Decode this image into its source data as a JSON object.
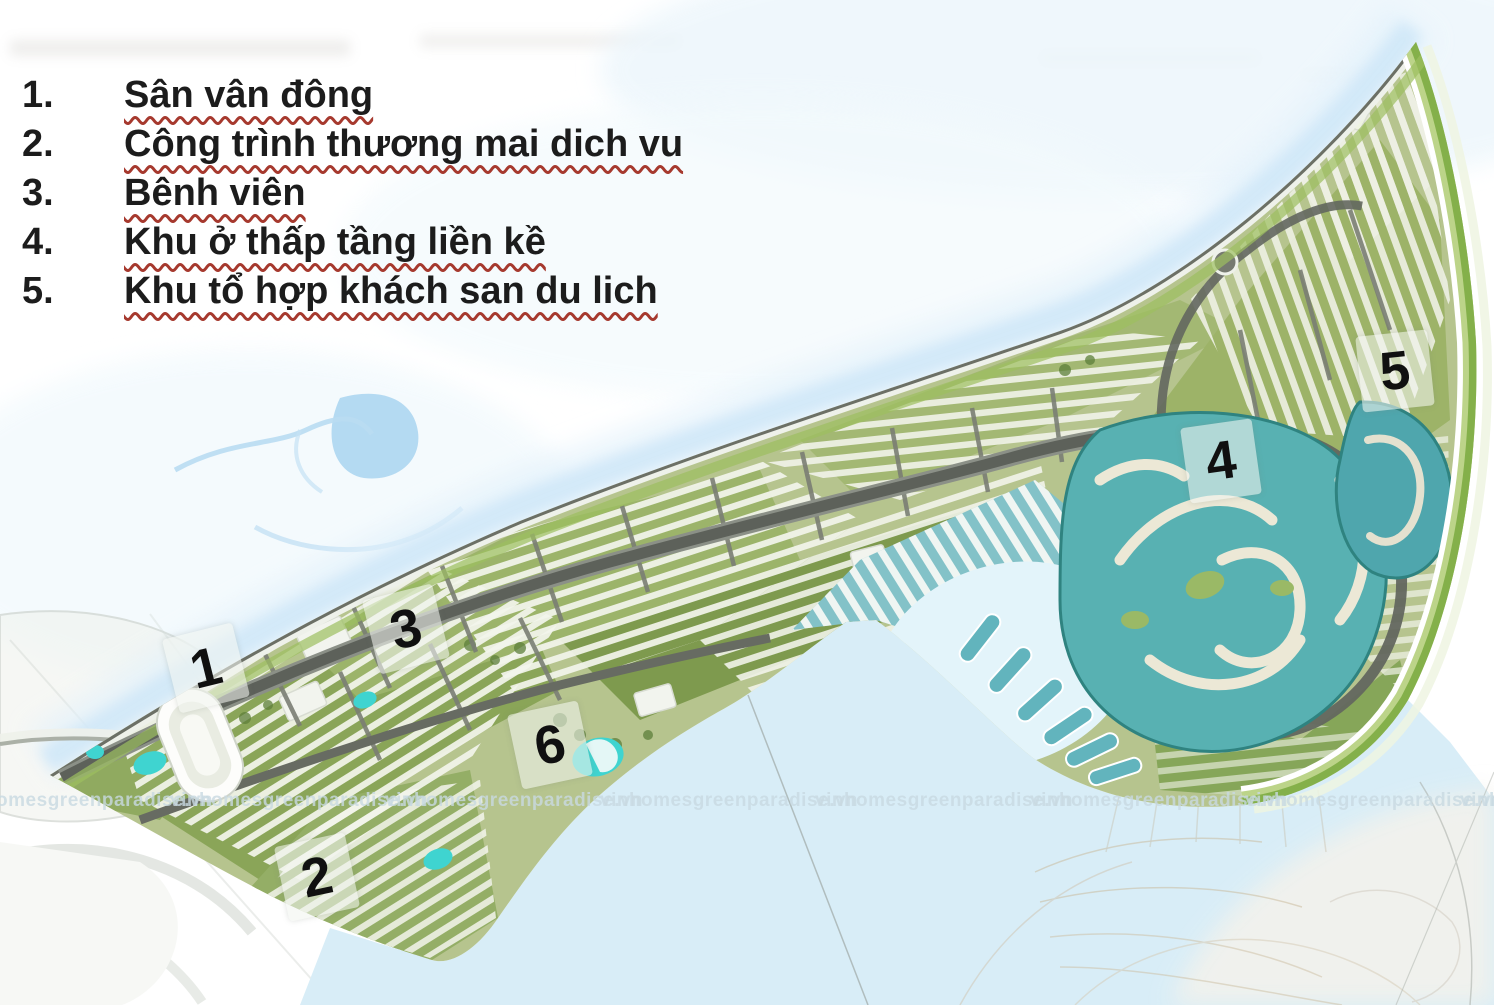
{
  "legend": {
    "items": [
      {
        "num": "1.",
        "label": "Sân vân đông"
      },
      {
        "num": "2.",
        "label": "Công trình thương mai dich vu"
      },
      {
        "num": "3.",
        "label": "Bênh viên"
      },
      {
        "num": "4.",
        "label": "Khu ở thấp tầng liền kề"
      },
      {
        "num": "5.",
        "label": "Khu tổ hợp khách san du lich"
      }
    ]
  },
  "map": {
    "markers": [
      {
        "label": "1",
        "x": 206,
        "y": 668,
        "rot": -14
      },
      {
        "label": "2",
        "x": 317,
        "y": 877,
        "rot": -12
      },
      {
        "label": "3",
        "x": 406,
        "y": 629,
        "rot": -14
      },
      {
        "label": "4",
        "x": 1221,
        "y": 461,
        "rot": -8
      },
      {
        "label": "5",
        "x": 1395,
        "y": 371,
        "rot": -6
      },
      {
        "label": "6",
        "x": 550,
        "y": 745,
        "rot": -12
      }
    ],
    "watermark": {
      "text": "vinhomesgreenparadise.vn",
      "xs": [
        -45,
        170,
        385,
        600,
        815,
        1030,
        1245,
        1460
      ]
    },
    "colors": {
      "legend_text": "#1c1c1c",
      "squiggle_red": "#a6392e",
      "marker_text": "#101010",
      "watermark_gray": "#c9dae2",
      "bay_water": "#d8edf7",
      "lagoon_teal": "#58b1b2",
      "marina_teal": "#83c2c8",
      "site_green": "#b6c48e",
      "park_green": "#7f9b50",
      "road_gray": "#5d615a",
      "edge_band_green": "#8db84d",
      "pool_cyan": "#3fd4d0"
    }
  }
}
